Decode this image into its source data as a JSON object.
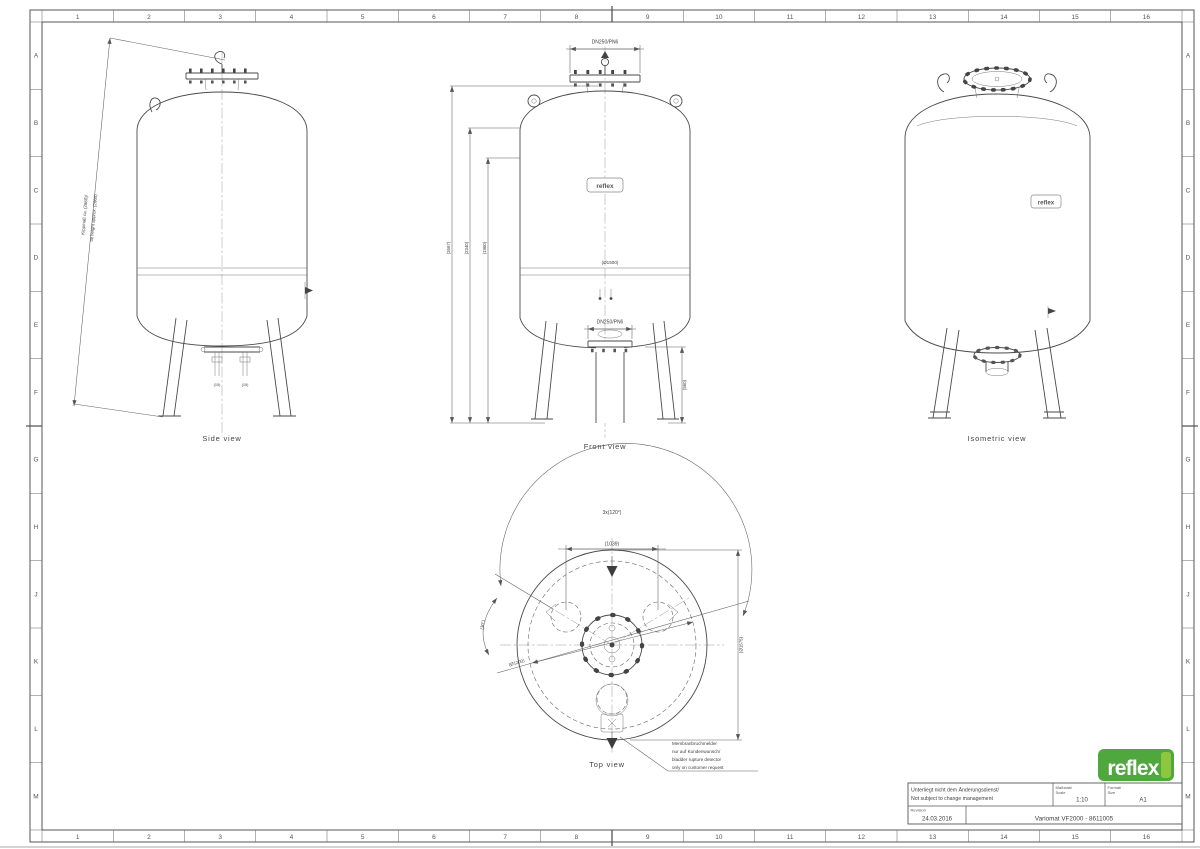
{
  "drawing": {
    "border": {
      "columns": [
        "1",
        "2",
        "3",
        "4",
        "5",
        "6",
        "7",
        "8",
        "9",
        "10",
        "11",
        "12",
        "13",
        "14",
        "15",
        "16"
      ],
      "rows": [
        "A",
        "B",
        "C",
        "D",
        "E",
        "F",
        "G",
        "H",
        "J",
        "K",
        "L",
        "M"
      ]
    },
    "views": {
      "side": {
        "label": "Side view",
        "tilt_dim_de": "Kippmaß ca. (2860)/",
        "tilt_dim_en": "tilt height approx. (2860)",
        "stud_dim": "(15)"
      },
      "front": {
        "label": "Front view",
        "top_flange_dim": "DN250/PN6",
        "bottom_flange_dim": "DN250/PN6",
        "height_total": "(2667)",
        "height_to_flange": "(2340)",
        "height_shell": "(1960)",
        "diameter": "(Ø1500)",
        "clearance": "(560)",
        "sticker": "reflex"
      },
      "isometric": {
        "label": "Isometric view",
        "sticker": "reflex"
      },
      "top": {
        "label": "Top view",
        "angle_dim": "3x(120°)",
        "feet_spacing_dim": "(1039)",
        "leg_angle_dim": "(30°)",
        "pitch_circle_dim": "(Ø1200)",
        "outer_diameter_dim": "(Ø1575)",
        "note_lines": [
          "Membranbruchmelder",
          "nur auf Kundenwunsch/",
          "bladder rupture detector",
          "only on customer request"
        ]
      }
    },
    "title_block": {
      "note_de": "Unterliegt nicht dem Änderungsdienst/",
      "note_en": "Not subject to change management",
      "scale_label_de": "Maßstab/",
      "scale_label_en": "Scale",
      "scale_value": "1:10",
      "format_label_de": "Format/",
      "format_label_en": "Size",
      "format_value": "A1",
      "revision_label": "Revision",
      "revision_date": "24.03.2016",
      "drawing_title": "Variomat VF2000 - 8611005"
    },
    "logo": {
      "text": "reflex",
      "green": "#4fa83d",
      "light_green": "#8dc63f"
    }
  }
}
